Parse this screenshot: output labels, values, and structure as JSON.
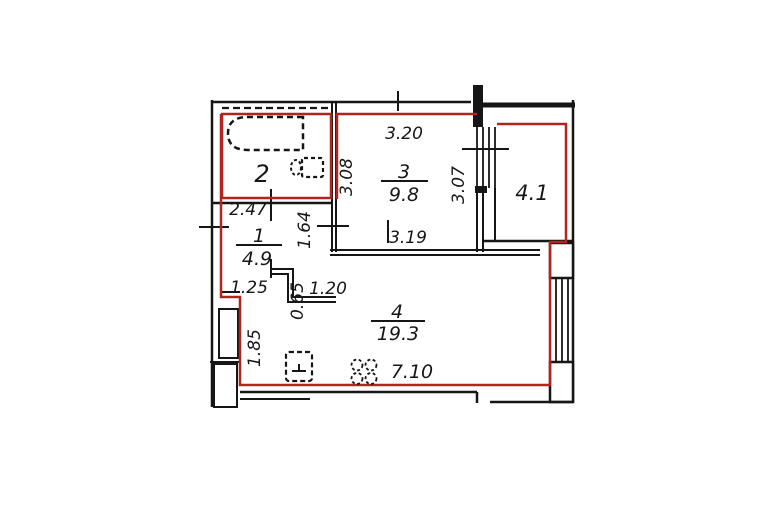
{
  "plan": {
    "colors": {
      "apartment_boundary": "#b22420",
      "walls": "#161616",
      "text": "#161616"
    },
    "rooms": {
      "hall": {
        "number": "1",
        "area": "4.9"
      },
      "bathroom": {
        "number": "2"
      },
      "room3": {
        "number": "3",
        "area": "9.8"
      },
      "room4": {
        "number": "4",
        "area": "19.3"
      },
      "balcony": {
        "area": "4.1"
      }
    },
    "dimensions": {
      "room3_top": "3.20",
      "room3_left": "3.08",
      "room3_right": "3.07",
      "room3_bottom": "3.19",
      "bathroom_width": "2.47",
      "hall_right": "1.64",
      "hall_bottom_left": "1.25",
      "hall_step": "0.65",
      "hall_bottom_right": "1.20",
      "room4_left": "1.85",
      "room4_bottom": "7.10"
    },
    "fixtures": [
      "bathtub",
      "toilet",
      "kitchen-sink",
      "stove"
    ]
  }
}
